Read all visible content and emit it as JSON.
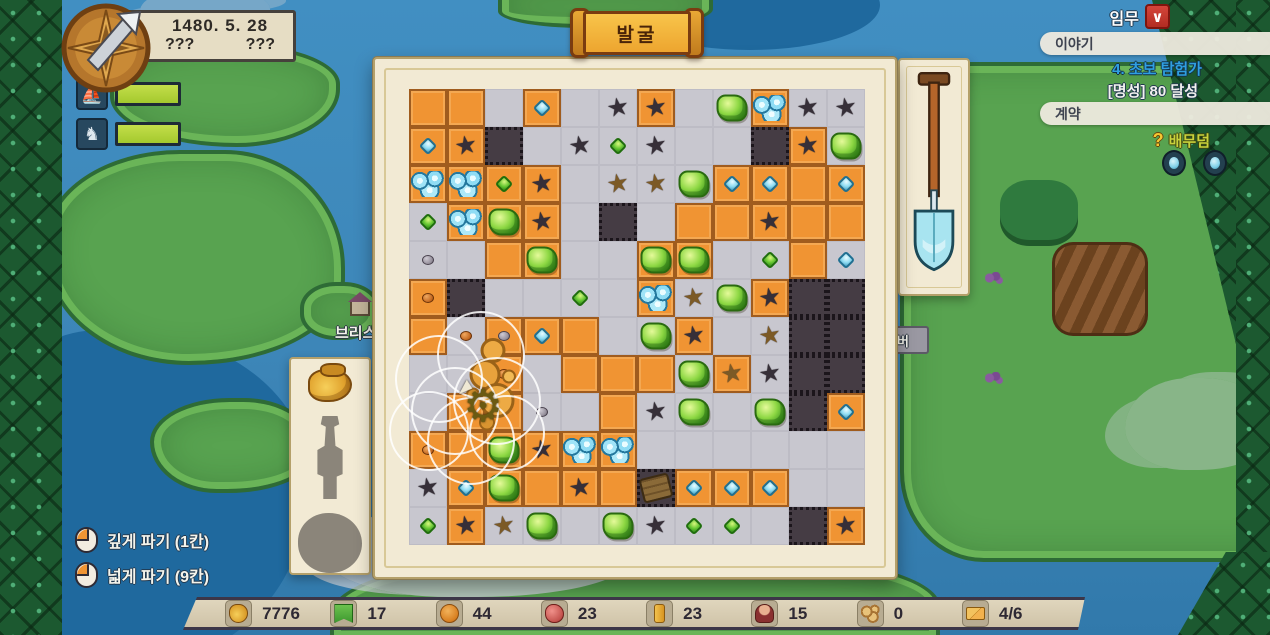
{
  "hud": {
    "date": "1480. 5. 28",
    "unknown_left": "???",
    "unknown_right": "???",
    "gauges": [
      {
        "icon": "ship-icon",
        "fill_pct": 100
      },
      {
        "icon": "horse-icon",
        "fill_pct": 100
      }
    ]
  },
  "quest": {
    "missions_label": "임무",
    "missions_badge_glyph": "∨",
    "story_header": "이야기",
    "story_quest_title": "4. 초보 탐험가",
    "story_quest_goal": "[명성] 80 달성",
    "contract_header": "계약",
    "contract_hint_icon": "question-icon",
    "contract_hint_glyph": "?",
    "contract_hint": "배무덤"
  },
  "banner": {
    "title": "발굴"
  },
  "map": {
    "labels": [
      {
        "text": "브리스"
      },
      {
        "text": "버"
      }
    ]
  },
  "dig_hints": [
    {
      "icon": "mouse-left-click-icon",
      "label": "깊게 파기 (1칸)"
    },
    {
      "icon": "mouse-left-click-icon",
      "label": "넓게 파기 (9칸)"
    }
  ],
  "artifact_panel": {
    "slots": [
      {
        "state": "found",
        "icon": "gold-pouch-icon"
      },
      {
        "state": "silhouette",
        "icon": "statue-silhouette-icon"
      },
      {
        "state": "silhouette",
        "icon": "round-silhouette-icon"
      }
    ]
  },
  "tool_panel": {
    "icon": "shovel-icon"
  },
  "resources": [
    {
      "icon": "money-pouch-icon",
      "value": "7776"
    },
    {
      "icon": "flag-icon",
      "value": "17"
    },
    {
      "icon": "bread-icon",
      "value": "44"
    },
    {
      "icon": "meat-icon",
      "value": "23"
    },
    {
      "icon": "gold-bar-icon",
      "value": "23"
    },
    {
      "icon": "person-icon",
      "value": "15"
    },
    {
      "icon": "logs-icon",
      "value": "0"
    },
    {
      "icon": "mail-icon",
      "value": "4/6"
    }
  ],
  "board": {
    "legend": {
      "O": "orange-soil",
      "G": "gray-dug",
      "D": "dark-deep"
    },
    "grid": [
      "OOGOGGOGGOGG",
      "OODGGGGGGDOG",
      "OOOOGGGGOOOO",
      "GOOOGDGOOOOO",
      "GGOOGGOOGGOG",
      "ODGGGGOGGODD",
      "OGOOOGGOGGDD",
      "GGOGOOOGOGDD",
      "GOOGGOGGGGDO",
      "OOOOOOGGGGGG",
      "GOOOOODOOOGG",
      "GOGGGGGGGGDO"
    ],
    "items": [
      {
        "r": 0,
        "c": 3,
        "t": "diamond-blue"
      },
      {
        "r": 0,
        "c": 5,
        "t": "star-dark"
      },
      {
        "r": 0,
        "c": 6,
        "t": "star-dark"
      },
      {
        "r": 0,
        "c": 8,
        "t": "gem-green-lg"
      },
      {
        "r": 0,
        "c": 9,
        "t": "gem-blue"
      },
      {
        "r": 0,
        "c": 10,
        "t": "star-dark"
      },
      {
        "r": 0,
        "c": 11,
        "t": "star-dark"
      },
      {
        "r": 1,
        "c": 0,
        "t": "diamond-blue"
      },
      {
        "r": 1,
        "c": 1,
        "t": "star-dark"
      },
      {
        "r": 1,
        "c": 4,
        "t": "star-dark"
      },
      {
        "r": 1,
        "c": 5,
        "t": "gem-green-sm"
      },
      {
        "r": 1,
        "c": 6,
        "t": "star-dark"
      },
      {
        "r": 1,
        "c": 10,
        "t": "star-dark"
      },
      {
        "r": 1,
        "c": 11,
        "t": "gem-green-lg"
      },
      {
        "r": 2,
        "c": 0,
        "t": "gem-blue"
      },
      {
        "r": 2,
        "c": 1,
        "t": "gem-blue"
      },
      {
        "r": 2,
        "c": 2,
        "t": "gem-green-sm"
      },
      {
        "r": 2,
        "c": 3,
        "t": "star-dark"
      },
      {
        "r": 2,
        "c": 5,
        "t": "star-brown"
      },
      {
        "r": 2,
        "c": 6,
        "t": "star-brown"
      },
      {
        "r": 2,
        "c": 7,
        "t": "gem-green-lg"
      },
      {
        "r": 2,
        "c": 8,
        "t": "diamond-blue"
      },
      {
        "r": 2,
        "c": 9,
        "t": "diamond-blue"
      },
      {
        "r": 2,
        "c": 11,
        "t": "diamond-blue"
      },
      {
        "r": 3,
        "c": 0,
        "t": "gem-green-sm"
      },
      {
        "r": 3,
        "c": 1,
        "t": "gem-blue"
      },
      {
        "r": 3,
        "c": 2,
        "t": "gem-green-lg"
      },
      {
        "r": 3,
        "c": 3,
        "t": "star-dark"
      },
      {
        "r": 3,
        "c": 9,
        "t": "star-dark"
      },
      {
        "r": 4,
        "c": 0,
        "t": "pebble-gray"
      },
      {
        "r": 4,
        "c": 3,
        "t": "gem-green-lg"
      },
      {
        "r": 4,
        "c": 6,
        "t": "gem-green-lg"
      },
      {
        "r": 4,
        "c": 7,
        "t": "gem-green-lg"
      },
      {
        "r": 4,
        "c": 9,
        "t": "gem-green-sm"
      },
      {
        "r": 4,
        "c": 11,
        "t": "diamond-blue"
      },
      {
        "r": 5,
        "c": 0,
        "t": "pebble-orange"
      },
      {
        "r": 5,
        "c": 4,
        "t": "gem-green-sm"
      },
      {
        "r": 5,
        "c": 6,
        "t": "gem-blue"
      },
      {
        "r": 5,
        "c": 7,
        "t": "star-brown"
      },
      {
        "r": 5,
        "c": 8,
        "t": "gem-green-lg"
      },
      {
        "r": 5,
        "c": 9,
        "t": "star-dark"
      },
      {
        "r": 6,
        "c": 1,
        "t": "pebble-orange"
      },
      {
        "r": 6,
        "c": 2,
        "t": "pebble-gray"
      },
      {
        "r": 6,
        "c": 3,
        "t": "diamond-blue"
      },
      {
        "r": 6,
        "c": 6,
        "t": "gem-green-lg"
      },
      {
        "r": 6,
        "c": 7,
        "t": "star-dark"
      },
      {
        "r": 6,
        "c": 9,
        "t": "star-brown"
      },
      {
        "r": 7,
        "c": 2,
        "t": "pebble-orange"
      },
      {
        "r": 7,
        "c": 7,
        "t": "gem-green-lg"
      },
      {
        "r": 7,
        "c": 8,
        "t": "star-brown"
      },
      {
        "r": 7,
        "c": 9,
        "t": "star-dark"
      },
      {
        "r": 8,
        "c": 3,
        "t": "pebble-gray"
      },
      {
        "r": 8,
        "c": 6,
        "t": "star-dark"
      },
      {
        "r": 8,
        "c": 7,
        "t": "gem-green-lg"
      },
      {
        "r": 8,
        "c": 9,
        "t": "gem-green-lg"
      },
      {
        "r": 8,
        "c": 11,
        "t": "diamond-blue"
      },
      {
        "r": 9,
        "c": 0,
        "t": "pebble-orange"
      },
      {
        "r": 9,
        "c": 2,
        "t": "gem-green-lg"
      },
      {
        "r": 9,
        "c": 3,
        "t": "star-dark"
      },
      {
        "r": 9,
        "c": 4,
        "t": "gem-blue"
      },
      {
        "r": 9,
        "c": 5,
        "t": "gem-blue"
      },
      {
        "r": 10,
        "c": 0,
        "t": "star-dark"
      },
      {
        "r": 10,
        "c": 1,
        "t": "diamond-blue"
      },
      {
        "r": 10,
        "c": 2,
        "t": "gem-green-lg"
      },
      {
        "r": 10,
        "c": 4,
        "t": "star-dark"
      },
      {
        "r": 10,
        "c": 6,
        "t": "chest"
      },
      {
        "r": 10,
        "c": 7,
        "t": "diamond-blue"
      },
      {
        "r": 10,
        "c": 8,
        "t": "diamond-blue"
      },
      {
        "r": 10,
        "c": 9,
        "t": "diamond-blue"
      },
      {
        "r": 11,
        "c": 0,
        "t": "gem-green-sm"
      },
      {
        "r": 11,
        "c": 1,
        "t": "star-dark"
      },
      {
        "r": 11,
        "c": 2,
        "t": "star-brown"
      },
      {
        "r": 11,
        "c": 3,
        "t": "gem-green-lg"
      },
      {
        "r": 11,
        "c": 5,
        "t": "gem-green-lg"
      },
      {
        "r": 11,
        "c": 6,
        "t": "star-dark"
      },
      {
        "r": 11,
        "c": 7,
        "t": "gem-green-sm"
      },
      {
        "r": 11,
        "c": 8,
        "t": "gem-green-sm"
      },
      {
        "r": 11,
        "c": 11,
        "t": "star-dark"
      }
    ],
    "artifact": {
      "type": "gold-statue",
      "x": 82,
      "y": 300
    },
    "effect": {
      "circles": [
        {
          "x": 30,
          "y": 290,
          "r": 44
        },
        {
          "x": 72,
          "y": 266,
          "r": 44
        },
        {
          "x": 46,
          "y": 322,
          "r": 44
        },
        {
          "x": 88,
          "y": 312,
          "r": 44
        },
        {
          "x": 20,
          "y": 342,
          "r": 40
        },
        {
          "x": 62,
          "y": 352,
          "r": 44
        },
        {
          "x": 98,
          "y": 344,
          "r": 38
        }
      ],
      "cursor": {
        "x": 74,
        "y": 318
      }
    }
  }
}
